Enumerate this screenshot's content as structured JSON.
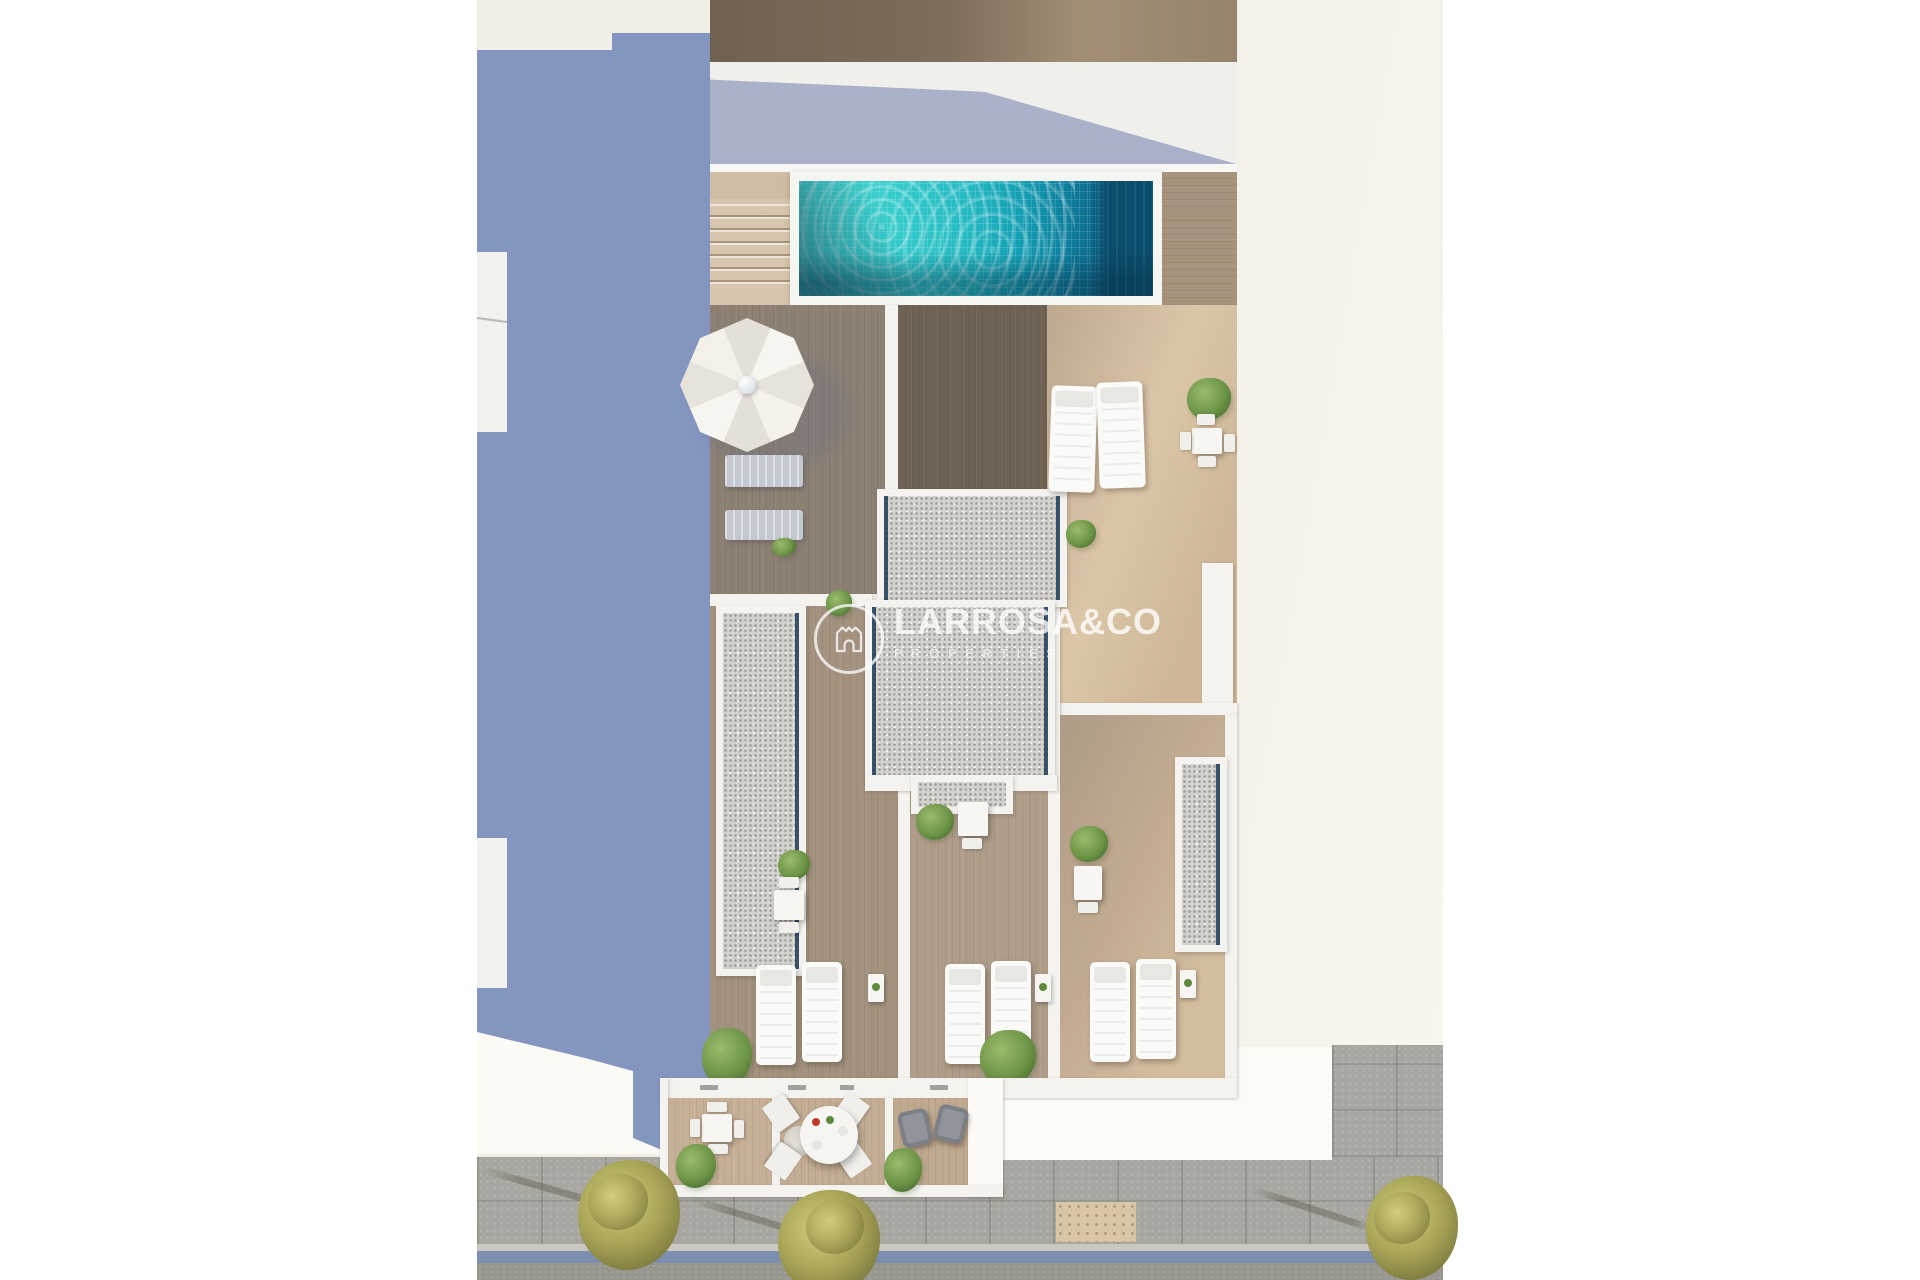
{
  "watermark": {
    "brand": "LARROSA&CO",
    "tagline": "PROPERTIES",
    "logo": "castle-crest-icon"
  },
  "scene": {
    "type": "aerial-3d-architectural-render",
    "subject": "rooftop solarium plan of a residential building with communal pool and private terraces",
    "communal_deck": {
      "pool": "rectangular tiled pool with dark deep end",
      "parasol": "white octagonal parasol",
      "double_loungers": 2,
      "stairs": "wood steps beside pool",
      "white_sunbeds": 2,
      "dining_set": "white table with four chairs",
      "gravel_roof": "central stair-core roof covered in gravel with skylight edges"
    },
    "private_terraces": {
      "count": 3,
      "each_has": [
        "two white sunbeds",
        "side table",
        "small dining table",
        "planter"
      ],
      "skylight_strips": 2
    },
    "lower_terraces": {
      "count": 3,
      "items": [
        "square dining set with four chairs",
        "round dining table with four chairs and rug",
        "two grey lounge armchairs",
        "planters"
      ]
    },
    "street": {
      "sidewalk": "paved sidewalk",
      "trees": 3,
      "lane_marking": "blue strip along curb",
      "road": "asphalt"
    }
  },
  "palette": {
    "margin-white": "#ffffff",
    "backdrop-warm": "#f2efe8",
    "shadow-periwinkle": "#8496c0",
    "facade-white": "#f0efec",
    "facade-shadow": "#a9b2c9",
    "pool-frame": "#f5f5f2",
    "pool-turquoise": "#35cbcb",
    "pool-deep": "#0a5f82",
    "skylight-navy": "#22405e",
    "gravel": "#d4d2cd",
    "wall-white": "#f4f3ef",
    "sidewalk": "#a7a6a0",
    "lane-blue": "#7d8fb0",
    "asphalt": "#97968f",
    "tactile-beige": "#d9c6a4",
    "white-furniture": "#fafaf8"
  }
}
